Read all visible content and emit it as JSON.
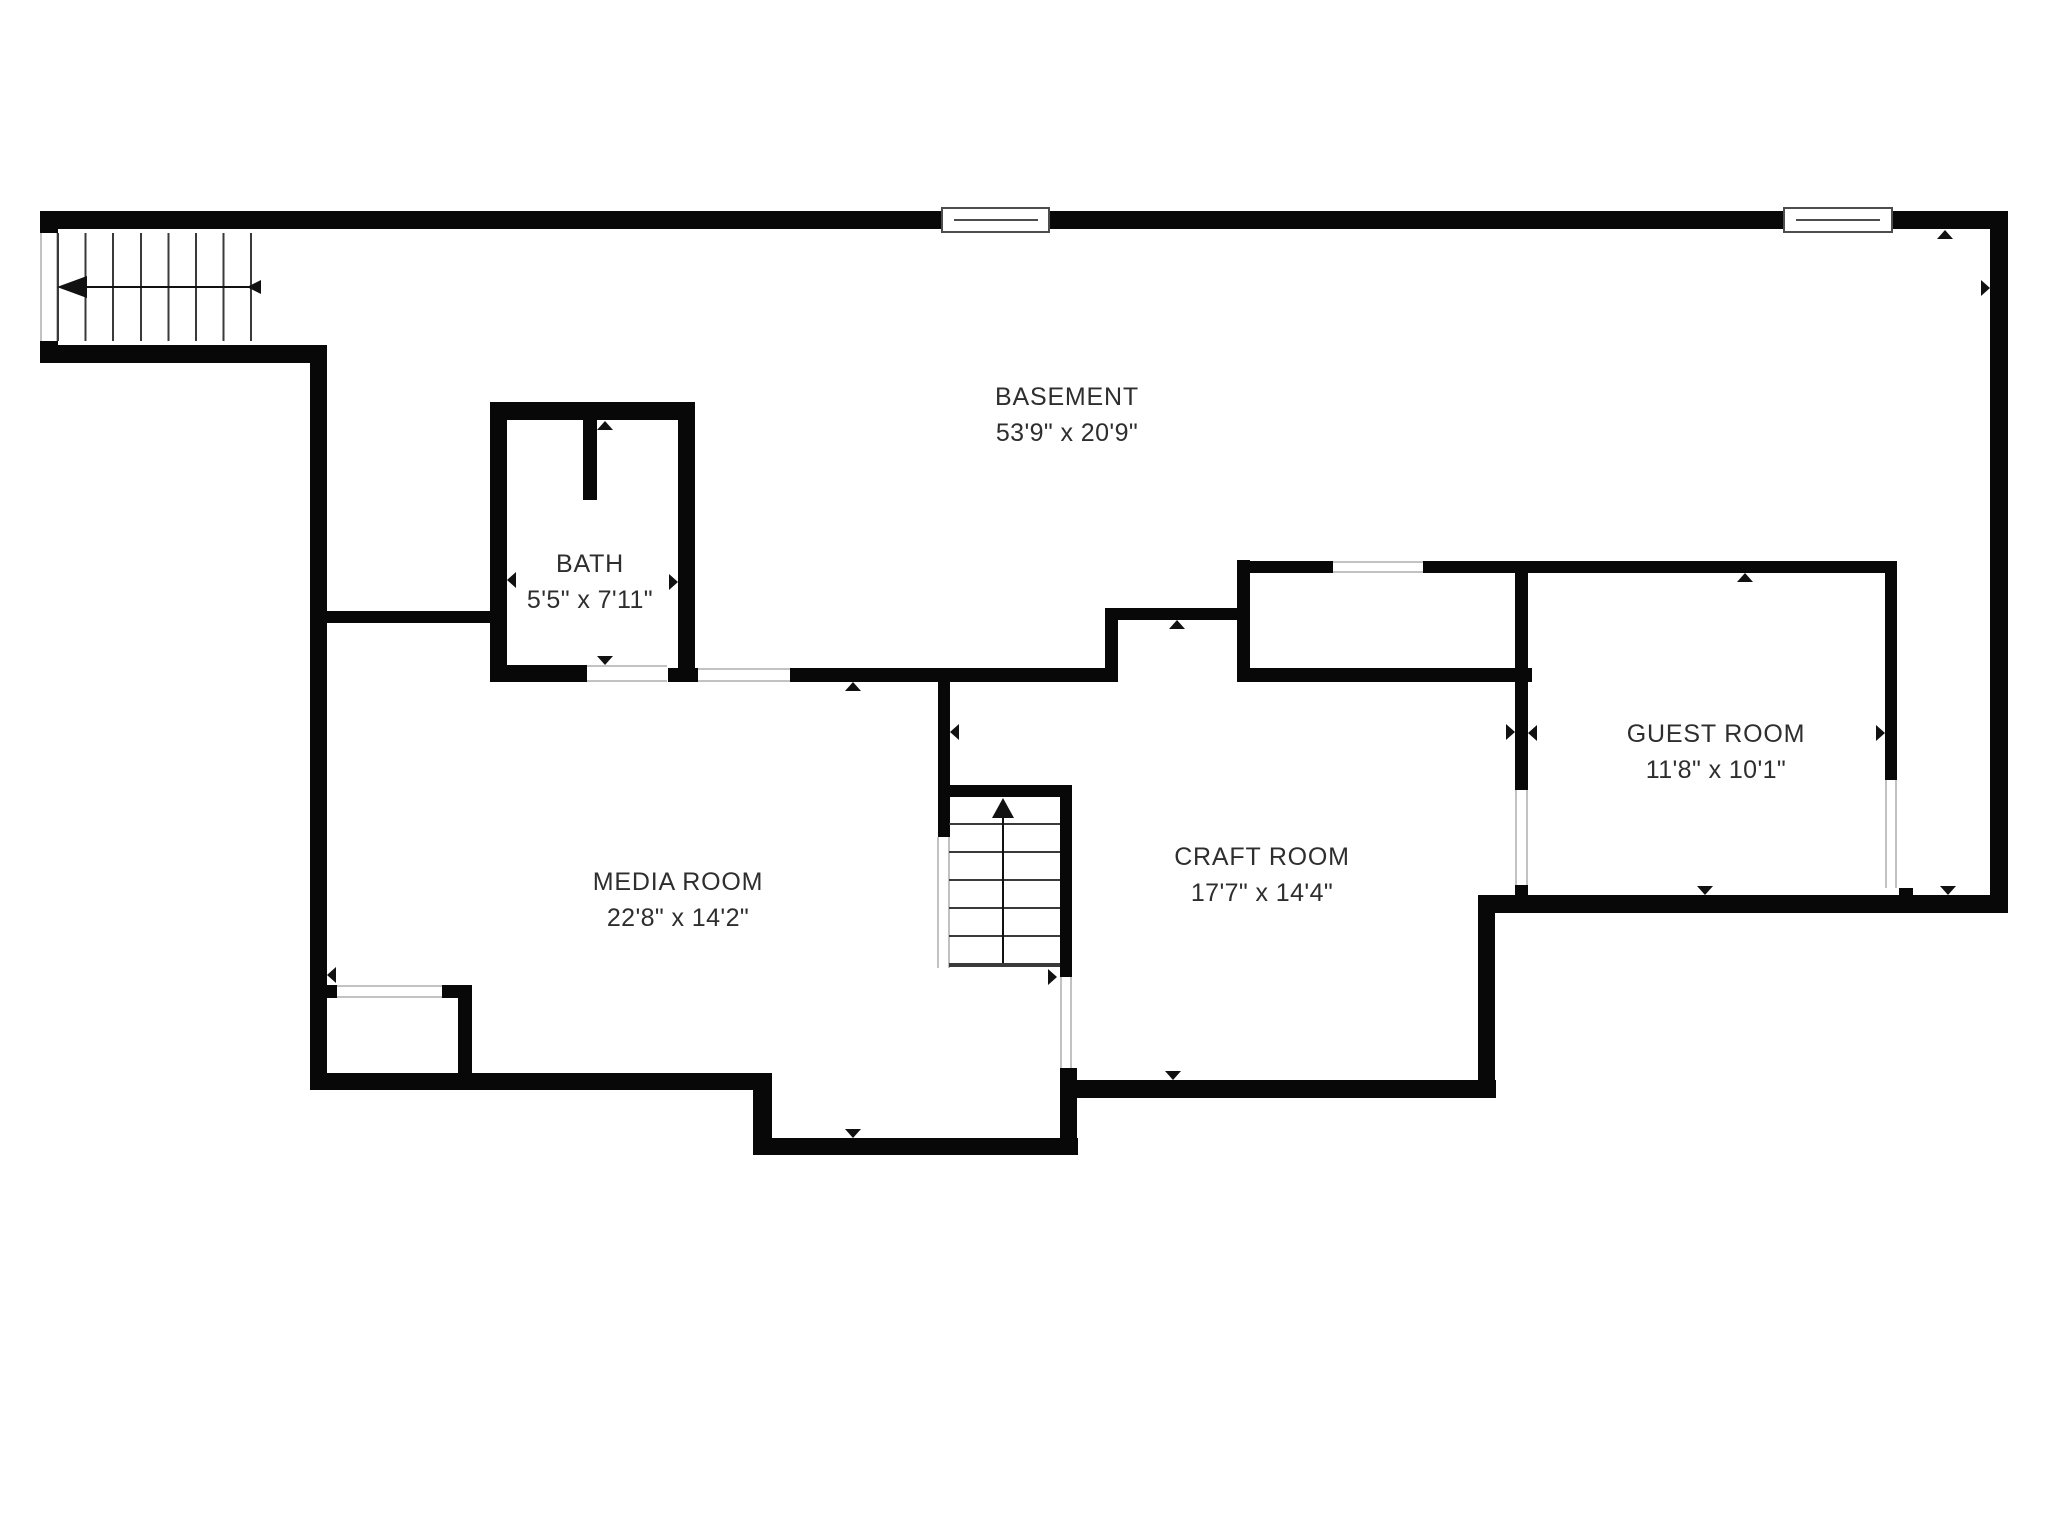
{
  "plan": {
    "rooms": [
      {
        "id": "basement",
        "name": "BASEMENT",
        "dimensions": "53'9\" x 20'9\""
      },
      {
        "id": "bath",
        "name": "BATH",
        "dimensions": "5'5\" x 7'11\""
      },
      {
        "id": "media-room",
        "name": "MEDIA ROOM",
        "dimensions": "22'8\" x 14'2\""
      },
      {
        "id": "craft-room",
        "name": "CRAFT ROOM",
        "dimensions": "17'7\" x 14'4\""
      },
      {
        "id": "guest-room",
        "name": "GUEST ROOM",
        "dimensions": "11'8\" x 10'1\""
      }
    ],
    "stairs": [
      {
        "id": "entry-stairs",
        "icon": "stair-arrow-left",
        "treads": 8
      },
      {
        "id": "lower-stairs",
        "icon": "stair-arrow-up",
        "treads": 6
      }
    ],
    "windows": {
      "count": 2
    },
    "colors": {
      "wall": "#080808",
      "background": "#ffffff",
      "text": "#2e2e2e",
      "opening_outline": "#c2c2c2",
      "window_outline": "#4d4d4d",
      "step_line": "#3a3a3a"
    }
  }
}
